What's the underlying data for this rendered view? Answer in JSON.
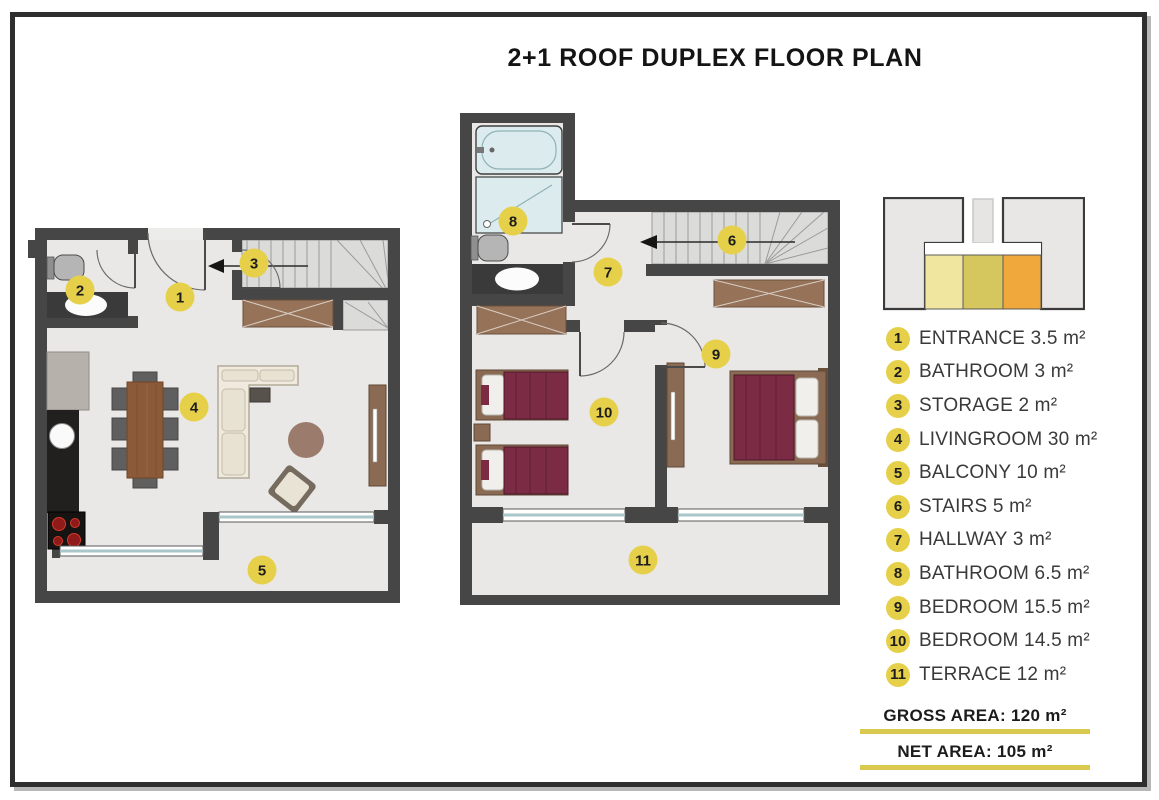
{
  "title": "2+1 ROOF DUPLEX FLOOR PLAN",
  "legend": [
    {
      "num": "1",
      "label": "ENTRANCE 3.5 m²"
    },
    {
      "num": "2",
      "label": "BATHROOM 3 m²"
    },
    {
      "num": "3",
      "label": "STORAGE 2 m²"
    },
    {
      "num": "4",
      "label": "LIVINGROOM 30 m²"
    },
    {
      "num": "5",
      "label": "BALCONY 10 m²"
    },
    {
      "num": "6",
      "label": "STAIRS 5 m²"
    },
    {
      "num": "7",
      "label": "HALLWAY 3 m²"
    },
    {
      "num": "8",
      "label": "BATHROOM 6.5 m²"
    },
    {
      "num": "9",
      "label": "BEDROOM 15.5 m²"
    },
    {
      "num": "10",
      "label": "BEDROOM 14.5 m²"
    },
    {
      "num": "11",
      "label": "TERRACE 12 m²"
    }
  ],
  "areas": {
    "gross": "GROSS AREA: 120 m²",
    "net": "NET AREA: 105 m²"
  },
  "key_plan": {
    "highlight_colors": [
      "#f0e6a0",
      "#d5c75e",
      "#f0a73b"
    ]
  },
  "colors": {
    "marker_yellow": "#e6d04a",
    "underline_yellow": "#d9c94f",
    "wall": "#464646",
    "floor": "#e9e8e6",
    "bed_maroon": "#7c2b44",
    "wood": "#8a6a52",
    "window_glass": "#a9c6ca"
  }
}
